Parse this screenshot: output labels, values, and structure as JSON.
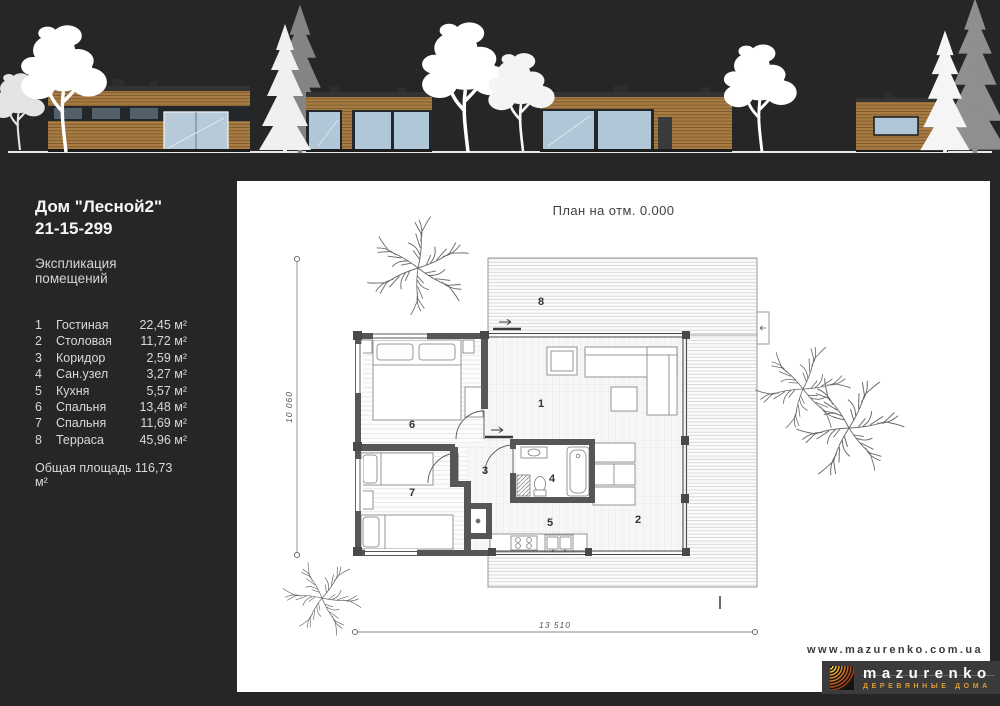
{
  "info": {
    "title": "Дом \"Лесной2\"",
    "code": "21-15-299",
    "schedule_title": "Экспликация помещений",
    "rooms": [
      {
        "num": "1",
        "name": "Гостиная",
        "area": "22,45 м²"
      },
      {
        "num": "2",
        "name": "Столовая",
        "area": "11,72 м²"
      },
      {
        "num": "3",
        "name": "Коридор",
        "area": "2,59 м²"
      },
      {
        "num": "4",
        "name": "Сан.узел",
        "area": "3,27 м²"
      },
      {
        "num": "5",
        "name": "Кухня",
        "area": "5,57 м²"
      },
      {
        "num": "6",
        "name": "Спальня",
        "area": "13,48 м²"
      },
      {
        "num": "7",
        "name": "Спальня",
        "area": "11,69 м²"
      },
      {
        "num": "8",
        "name": "Терраса",
        "area": "45,96 м²"
      }
    ],
    "total": "Общая площадь 116,73 м²"
  },
  "plan": {
    "title": "План на отм. 0.000",
    "dims": {
      "width": "13 510",
      "height": "10 060"
    },
    "labels": {
      "r1": "1",
      "r2": "2",
      "r3": "3",
      "r4": "4",
      "r5": "5",
      "r6": "6",
      "r7": "7",
      "r8": "8"
    }
  },
  "footer": {
    "url": "www.mazurenko.com.ua",
    "brand": "mazurenko",
    "tagline": "ДЕРЕВЯННЫЕ ДОМА"
  },
  "colors": {
    "background": "#262626",
    "wood": "#a87c42",
    "glass": "#b6cad9",
    "accent_orange": "#dc9c33",
    "wall_gray": "#565656"
  }
}
